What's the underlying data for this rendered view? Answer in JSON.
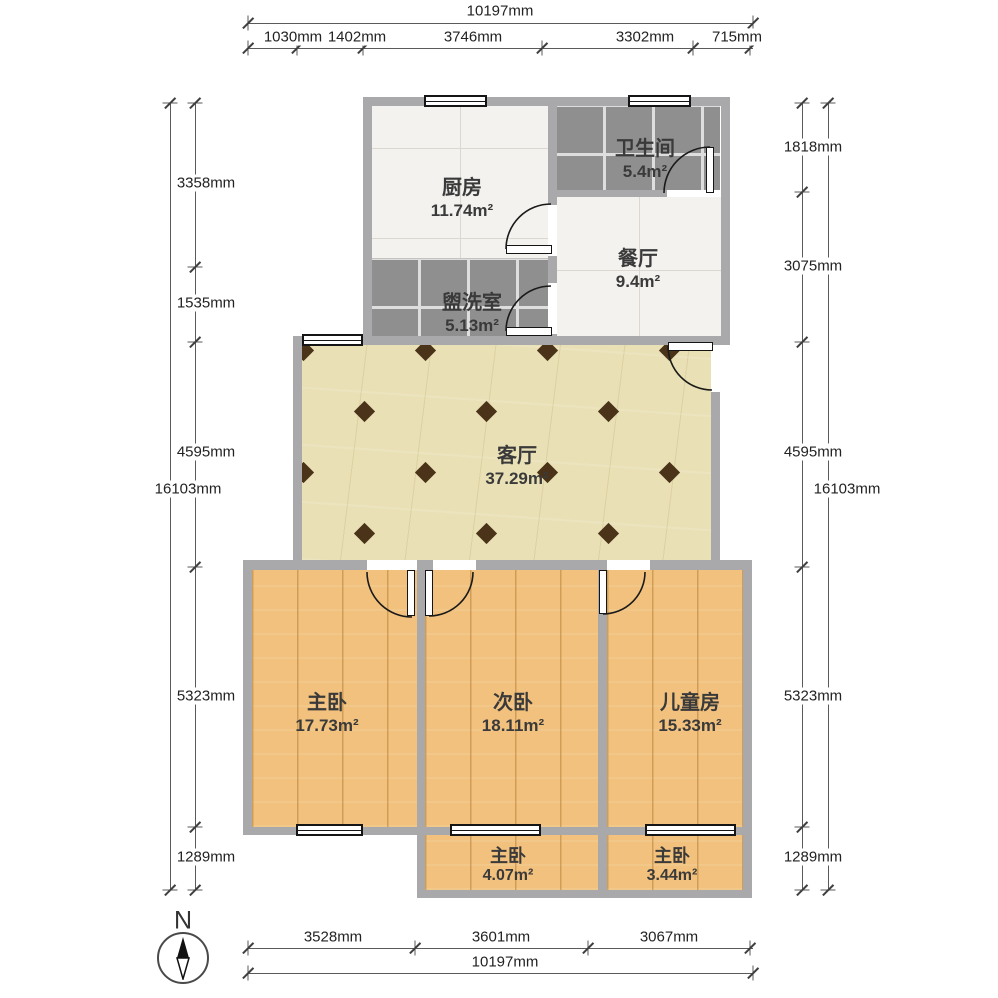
{
  "rooms": {
    "kitchen": {
      "name": "厨房",
      "area": "11.74m²"
    },
    "bathroom": {
      "name": "卫生间",
      "area": "5.4m²"
    },
    "dining": {
      "name": "餐厅",
      "area": "9.4m²"
    },
    "washroom": {
      "name": "盥洗室",
      "area": "5.13m²"
    },
    "living": {
      "name": "客厅",
      "area": "37.29m²"
    },
    "master": {
      "name": "主卧",
      "area": "17.73m²"
    },
    "second": {
      "name": "次卧",
      "area": "18.11m²"
    },
    "kids": {
      "name": "儿童房",
      "area": "15.33m²"
    },
    "balcony_left": {
      "name": "主卧",
      "area": "4.07m²"
    },
    "balcony_right": {
      "name": "主卧",
      "area": "3.44m²"
    }
  },
  "dimensions": {
    "top": {
      "total": "10197mm",
      "seg1": "1030mm",
      "seg2": "1402mm",
      "seg3": "3746mm",
      "seg4": "3302mm",
      "seg5": "715mm"
    },
    "bottom": {
      "total": "10197mm",
      "seg1": "3528mm",
      "seg2": "3601mm",
      "seg3": "3067mm"
    },
    "left": {
      "total": "16103mm",
      "seg1": "3358mm",
      "seg2": "1535mm",
      "seg3": "4595mm",
      "seg4": "5323mm",
      "seg5": "1289mm"
    },
    "right": {
      "total": "16103mm",
      "seg1": "1818mm",
      "seg2": "3075mm",
      "seg3": "4595mm",
      "seg4": "5323mm",
      "seg5": "1289mm"
    }
  },
  "compass": {
    "label": "N"
  },
  "colors": {
    "wall": "#a9a9ab",
    "wood_floor": "#f1c17d",
    "living_floor": "#e9e0b5",
    "tile_white": "#f3f2ef",
    "tile_gray": "#8f8f90",
    "diamond": "#4a3318"
  }
}
